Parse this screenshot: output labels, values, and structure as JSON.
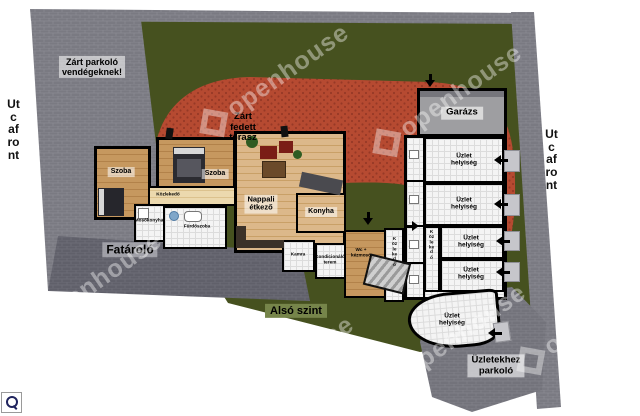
{
  "site": {
    "street_front_left": "Utcafront",
    "street_front_right": "Utcafront",
    "guest_parking_label": "Zárt parkoló\nvendégeknek!",
    "terrace_label": "Zárt\nfedett\nterasz",
    "wood_storage_label": "Fatároló",
    "level_label": "Alsó szint",
    "shops_parking_label": "Üzletekhez\nparkoló",
    "colors": {
      "lawn_green": "#46511f",
      "pavement_gray": "#7a7a82",
      "pavement_dark": "#62626a",
      "terrace_red": "#b64a31",
      "wall_black": "#000000",
      "level_badge_green": "#76854a"
    }
  },
  "house": {
    "bedroom_1": "Szoba",
    "bedroom_2": "Szoba",
    "hallway": "Közlekedő",
    "utility_room": "Mosókonyha",
    "bathroom": "Fürdőszoba",
    "living_dining": "Nappali\nétkező",
    "kitchen": "Konyha",
    "pantry": "Kamra",
    "fitness_room": "Kondicionáló\nterem",
    "wc": "Wc +\nkézmosó",
    "corridor": "Közlekedő"
  },
  "shops_building": {
    "garage": "Garázs",
    "corridor": "Közlekedő",
    "units": [
      {
        "label": "Üzlet\nhelyiség"
      },
      {
        "label": "Üzlet\nhelyiség"
      },
      {
        "label": "Üzlet\nhelyiség"
      },
      {
        "label": "Üzlet\nhelyiség"
      },
      {
        "label": "Üzlet\nhelyiség"
      }
    ]
  },
  "watermark": {
    "text": "openhouse"
  },
  "zoom_control": {
    "icon": "magnifier"
  }
}
